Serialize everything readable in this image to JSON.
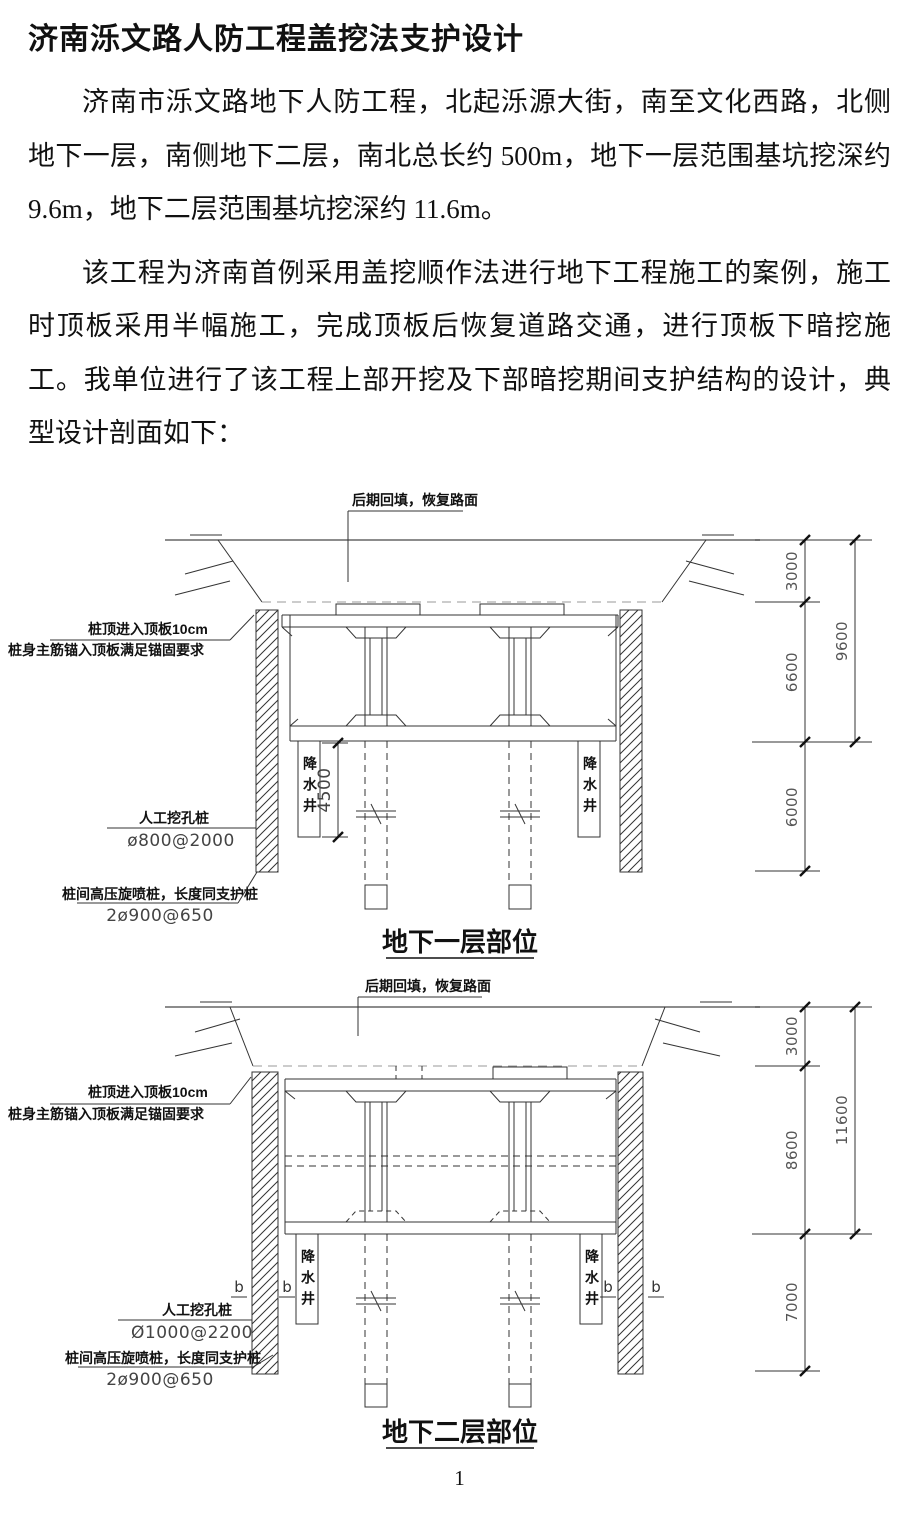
{
  "page": {
    "number": "1"
  },
  "document": {
    "title": "济南泺文路人防工程盖挖法支护设计",
    "paragraph1": "济南市泺文路地下人防工程，北起泺源大街，南至文化西路，北侧地下一层，南侧地下二层，南北总长约 500m，地下一层范围基坑挖深约 9.6m，地下二层范围基坑挖深约 11.6m。",
    "paragraph2": "该工程为济南首例采用盖挖顺作法进行地下工程施工的案例，施工时顶板采用半幅施工，完成顶板后恢复道路交通，进行顶板下暗挖施工。我单位进行了该工程上部开挖及下部暗挖期间支护结构的设计，典型设计剖面如下："
  },
  "figures": [
    {
      "caption": "地下一层部位",
      "labels": {
        "backfill": "后期回填，恢复路面",
        "pile_top_line1": "桩顶进入顶板10cm",
        "pile_top_line2": "桩身主筋锚入顶板满足锚固要求",
        "hand_dug_pile": "人工挖孔桩",
        "hand_dug_pile_spec": "ø800@2000",
        "jet_grouting": "桩间高压旋喷桩，长度同支护桩",
        "jet_grouting_spec": "2ø900@650",
        "well": "降水井",
        "well_depth": "4500"
      },
      "dims": {
        "top": "3000",
        "middle": "6600",
        "overall": "9600",
        "bottom": "6000"
      }
    },
    {
      "caption": "地下二层部位",
      "labels": {
        "backfill": "后期回填，恢复路面",
        "pile_top_line1": "桩顶进入顶板10cm",
        "pile_top_line2": "桩身主筋锚入顶板满足锚固要求",
        "hand_dug_pile": "人工挖孔桩",
        "hand_dug_pile_spec": "Ø1000@2200",
        "jet_grouting": "桩间高压旋喷桩，长度同支护桩",
        "jet_grouting_spec": "2ø900@650",
        "well": "降水井",
        "section_mark": "b"
      },
      "dims": {
        "top": "3000",
        "middle": "8600",
        "overall": "11600",
        "bottom": "7000"
      }
    }
  ]
}
